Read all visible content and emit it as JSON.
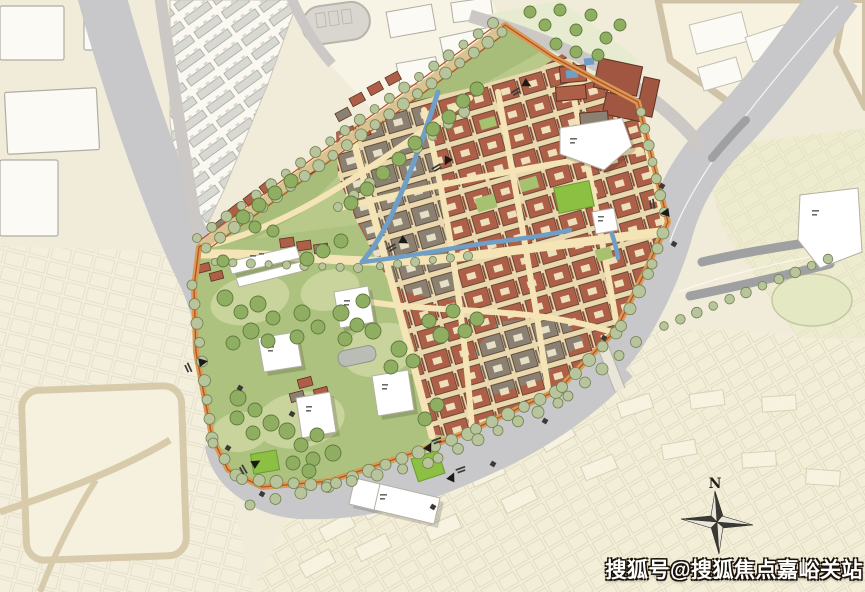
{
  "title": "historic district master plan map",
  "watermark": {
    "text": "搜狐号@搜狐焦点嘉峪关站"
  },
  "compass": {
    "north_label": "N"
  },
  "icons": [
    "compass-rose-icon",
    "road-entrance-arrow-icon",
    "tree-icon"
  ],
  "palette": {
    "bg": "#f1ecda",
    "fabric": "#f4efdd",
    "fabric2": "#f3eed7",
    "fabric_line": "#dcd5bd",
    "white_block": "#fbfaf4",
    "block_stroke": "#b0ada3",
    "road": "#cbc8c5",
    "river": "#c8c8ca",
    "lane_dark": "#9fa0a2",
    "lane_white": "#ffffff",
    "track": "#d9d6d0",
    "park": "#aec27f",
    "park2": "#a9bd7a",
    "park_light": "#c8d49b",
    "park_dark": "#8aa862",
    "tree_fill": "#b7c49c",
    "tree_stroke": "#72814f",
    "park_tree": "#8fae62",
    "park_tree_stroke": "#5e7a3c",
    "bright_green": "#8cc043",
    "bright_green_stroke": "#6a9a2e",
    "street": "#f4e4b6",
    "block_bg": "#ead8ae",
    "roof_red": "#ae5f48",
    "roof_red_dark": "#a05640",
    "roof_accent": "#8a4836",
    "roof_grey": "#8b8173",
    "roof_grey_accent": "#6f675c",
    "roof_stroke": "#5e4433",
    "courtyard": "#eee0bc",
    "canal": "#6f9fc6",
    "boundary_road": "#d89a55",
    "boundary_line": "#b94f25",
    "road_tan": "#d8cbab",
    "white_bld": "#ffffff",
    "white_bld_stroke": "#b4b0a4",
    "bridge": "#e9e5d8",
    "mark": "#3c3a36",
    "ink": "#1f1d1a",
    "watermark": "#ffffff"
  }
}
